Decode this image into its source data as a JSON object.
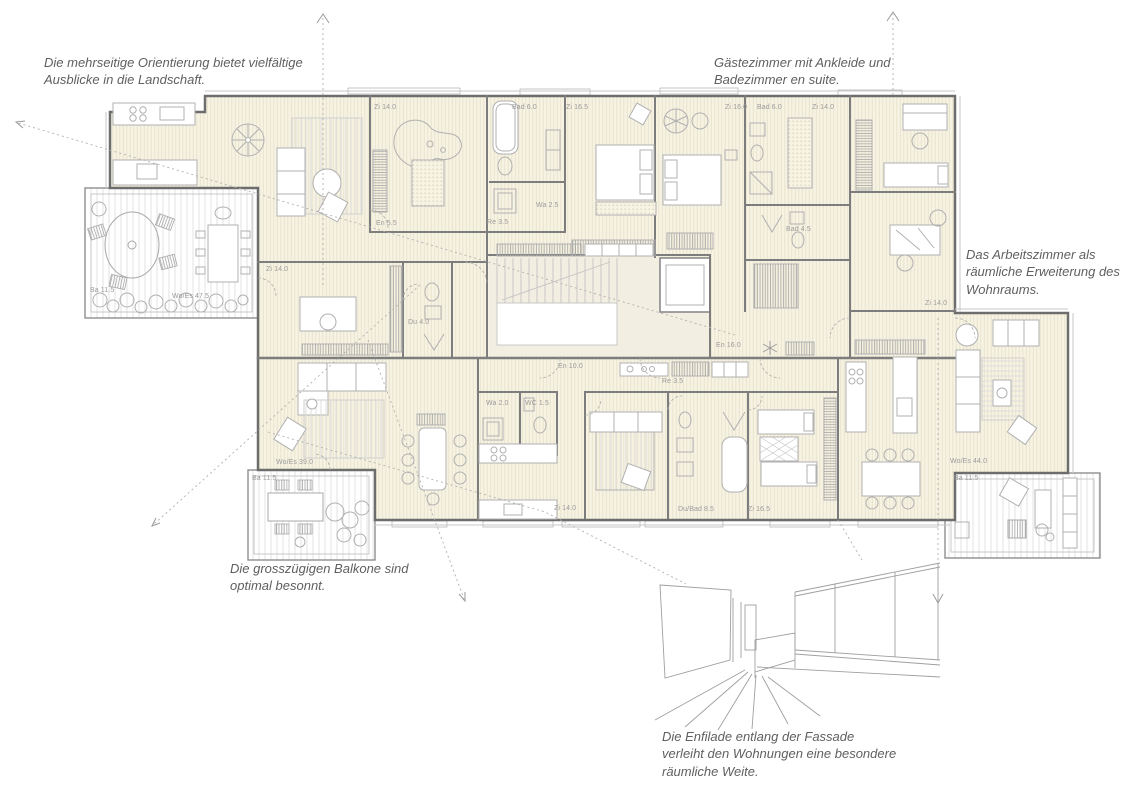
{
  "annotations": {
    "orientation": "Die mehrseitige Orientierung bietet vielfältige Ausblicke in die Landschaft.",
    "guest": "Gästezimmer mit Ankleide und Badezimmer en suite.",
    "study": "Das Arbeitszimmer als räumliche Erweiterung des Wohnraums.",
    "balconies": "Die grosszügigen Balkone sind optimal besonnt.",
    "enfilade": "Die Enfilade entlang der Fassade verleiht den Wohnungen eine besondere räumliche Weite."
  },
  "room_labels": [
    "Zi 14.0",
    "En 5.5",
    "Ba 11.5",
    "Wo/Es 47.5",
    "Zi 14.0",
    "Du 4.0",
    "Bad 6.0",
    "Zi 16.5",
    "Wa 2.5",
    "Re 3.5",
    "Zi 16.0",
    "Bad 6.0",
    "Zi 14.0",
    "Bad 4.5",
    "Zi 14.0",
    "En 16.0",
    "En 10.0",
    "Re 3.5",
    "Wa 2.0",
    "WC 1.5",
    "Wo/Es 39.0",
    "Ba 11.5",
    "Zi 14.0",
    "Du/Bad 8.5",
    "Zi 16.5",
    "Wo/Es 44.0",
    "Ba 11.5"
  ],
  "colors": {
    "plan_fill": "#f7f3e3",
    "wall": "#6d6d6d",
    "furniture_line": "#b0b0b0",
    "label_text": "#9b9b9b",
    "annotation_text": "#5f5f5f"
  }
}
